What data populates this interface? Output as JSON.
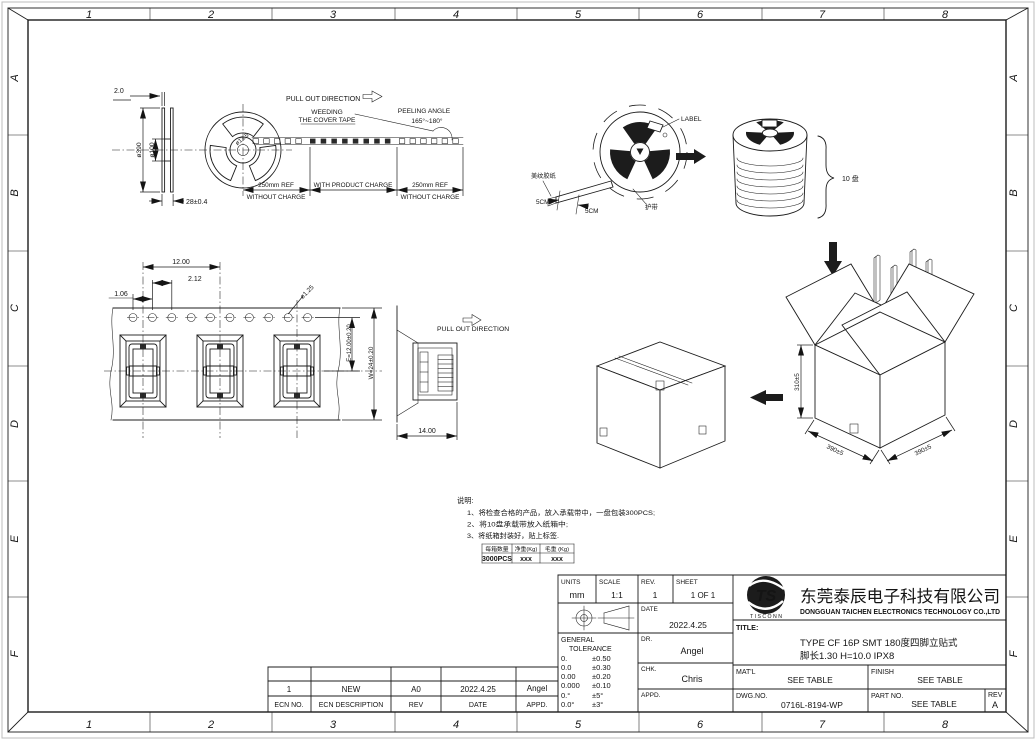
{
  "border": {
    "cols": [
      "1",
      "2",
      "3",
      "4",
      "5",
      "6",
      "7",
      "8"
    ],
    "rows": [
      "A",
      "B",
      "C",
      "D",
      "E",
      "F"
    ]
  },
  "reel": {
    "flange_thickness": "2.0",
    "outer_dia": "ø390",
    "hub_dia": "ø100",
    "width": "28±0.4",
    "center_hole": "ø13.5",
    "pull_out": "PULL OUT DIRECTION",
    "weeding_line1": "WEEDING",
    "weeding_line2": "THE COVER TAPE",
    "peeling_line1": "PEELING ANGLE",
    "peeling_line2": "165°~180°",
    "seg_left_1": "250mm REF",
    "seg_left_2": "WITHOUT CHARGE",
    "seg_mid": "WITH PRODUCT CHARGE",
    "seg_right_1": "250mm REF",
    "seg_right_2": "WITHOUT CHARGE"
  },
  "carrier": {
    "pitch": "12.00",
    "dim_2_12": "2.12",
    "dim_1_06": "1.06",
    "hole_dia": "ø1.25",
    "dim_e": "E=12.00±0.20",
    "dim_w": "W=24±0.20",
    "pull_out": "PULL OUT DIRECTION",
    "width": "14.00"
  },
  "packing": {
    "label": "LABEL",
    "masking_tape": "美纹胶纸",
    "protective_tape": "护带",
    "dim_5cm_left": "5CM",
    "dim_5cm_right": "5CM",
    "stack_qty": "10 盘",
    "box_height": "310±5",
    "box_width": "390±5",
    "box_depth": "390±5"
  },
  "notes": {
    "title": "说明:",
    "line1": "1、将检查合格的产品，放入承载带中，一盘包装300PCS;",
    "line2": "2、将10盘承载带放入纸箱中;",
    "line3": "3、将纸箱封装好，贴上标签."
  },
  "qty_table": {
    "headers": [
      "每箱数量",
      "净重(Kg)",
      "毛重 (Kg)"
    ],
    "values": [
      "3000PCS",
      "xxx",
      "xxx"
    ]
  },
  "ecn": {
    "entry": {
      "no": "1",
      "description": "NEW",
      "rev": "A0",
      "date": "2022.4.25",
      "appd": "Angel"
    },
    "headers": {
      "no": "ECN NO.",
      "description": "ECN  DESCRIPTION",
      "rev": "REV",
      "date": "DATE",
      "appd": "APPD."
    }
  },
  "titleblock": {
    "units_label": "UNITS",
    "units": "mm",
    "scale_label": "SCALE",
    "scale": "1:1",
    "rev_label": "REV.",
    "rev": "1",
    "sheet_label": "SHEET",
    "sheet": "1 OF 1",
    "date_label": "DATE",
    "date": "2022.4.25",
    "gt1": "GENERAL",
    "gt2": "TOLERANCE",
    "tol": [
      [
        "0.",
        "±0.50"
      ],
      [
        "0.0",
        "±0.30"
      ],
      [
        "0.00",
        "±0.20"
      ],
      [
        "0.000",
        "±0.10"
      ],
      [
        "0.°",
        "±5°"
      ],
      [
        "0.0°",
        "±3°"
      ]
    ],
    "dr_label": "DR.",
    "dr": "Angel",
    "chk_label": "CHK.",
    "chk": "Chris",
    "appd_label": "APPD.",
    "appd": "",
    "logo_text": "TS",
    "logo_sub": "T I S C O N N",
    "company_cn": "东莞泰辰电子科技有限公司",
    "company_en": "DONGGUAN TAICHEN ELECTRONICS TECHNOLOGY CO.,LTD",
    "title_label": "TITLE:",
    "title_line1": "TYPE CF 16P SMT 180度四脚立贴式",
    "title_line2": "脚长1.30 H=10.0 IPX8",
    "matl_label": "MAT'L",
    "matl": "SEE TABLE",
    "finish_label": "FINISH",
    "finish": "SEE TABLE",
    "dwg_label": "DWG.NO.",
    "dwg": "0716L-8194-WP",
    "part_label": "PART NO.",
    "part": "SEE TABLE",
    "rev_cell_label": "REV",
    "rev_cell": "A"
  }
}
